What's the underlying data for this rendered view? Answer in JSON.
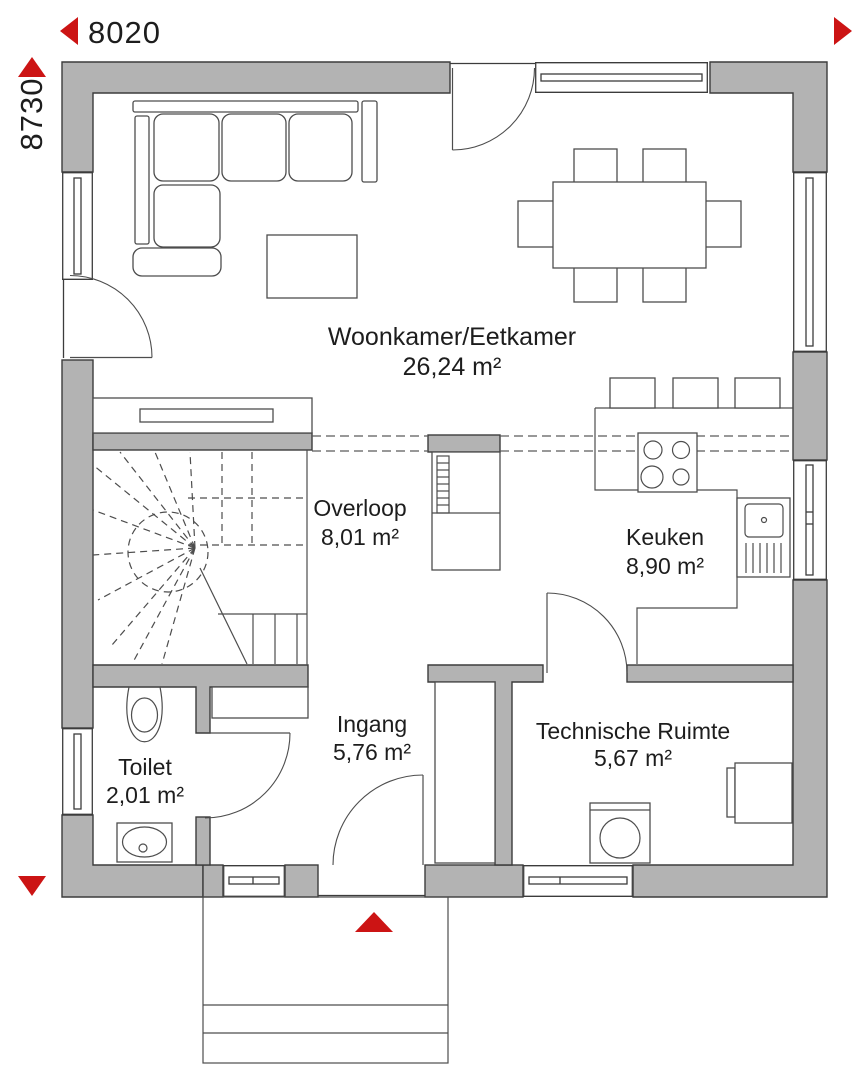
{
  "plan": {
    "title": "floor-plan-ground-floor",
    "dimensions": {
      "width_label": "8020",
      "height_label": "8730"
    },
    "rooms": [
      {
        "id": "woonkamer",
        "name": "Woonkamer/Eetkamer",
        "area": "26,24 m²"
      },
      {
        "id": "overloop",
        "name": "Overloop",
        "area": "8,01 m²"
      },
      {
        "id": "keuken",
        "name": "Keuken",
        "area": "8,90 m²"
      },
      {
        "id": "toilet",
        "name": "Toilet",
        "area": "2,01 m²"
      },
      {
        "id": "ingang",
        "name": "Ingang",
        "area": "5,76 m²"
      },
      {
        "id": "technische",
        "name": "Technische Ruimte",
        "area": "5,67 m²"
      }
    ],
    "colors": {
      "wall": "#b3b3b3",
      "line": "#3c3c3c",
      "furnline": "#4d4d4d",
      "accent": "#cc1414",
      "text": "#1d1d1d",
      "bg": "#ffffff"
    }
  }
}
